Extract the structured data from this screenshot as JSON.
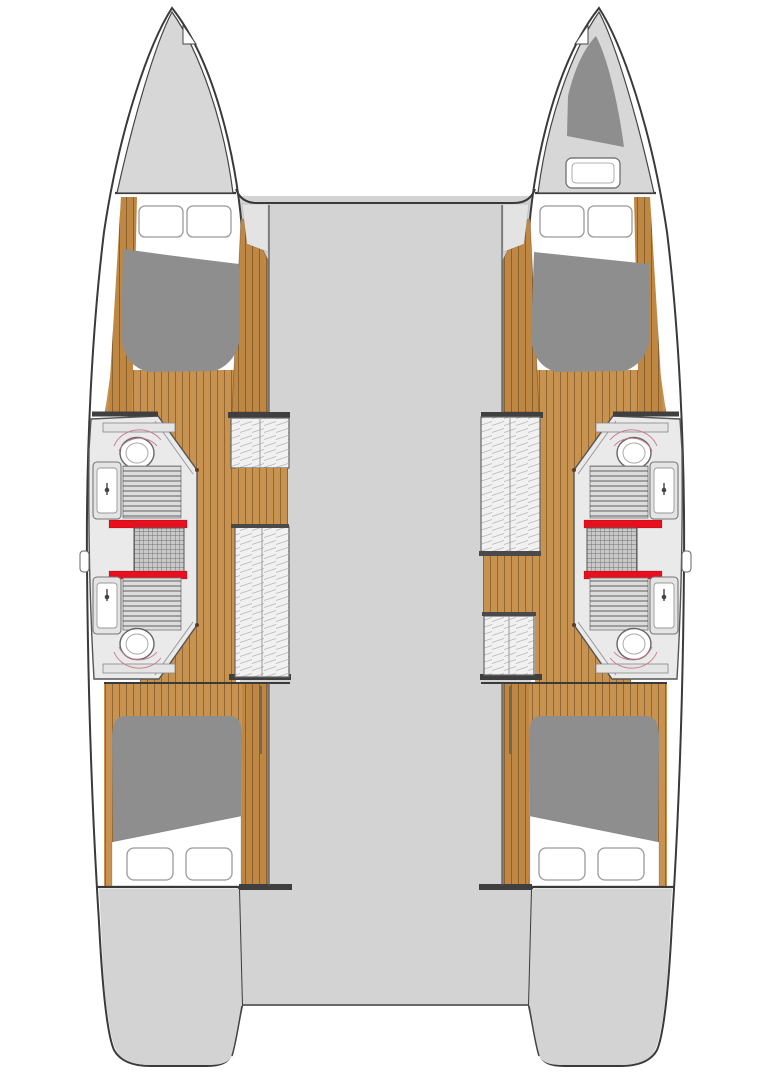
{
  "page": {
    "title": "Catamaran floor plan",
    "description": "Top-view interior layout floor plan of a four-cabin sailing catamaran: two symmetric hulls, each with a forward double cabin, two bathrooms with toilet and sink separated by a central shower grating with red thresholds, wardrobes along the inner wall, an aft double cabin, connected by a central bridge deck with bow trampoline gap and stern cockpit notch.",
    "width_px": 771,
    "height_px": 1080
  },
  "colors": {
    "background": "#FFFFFF",
    "outline": "#3A3A3A",
    "deck": "#D3D3D4",
    "foredeck": "#D7D7D7",
    "side_strip": "#E3E3E3",
    "wood": "#C89350",
    "wood_dark": "#BE8743",
    "mattress": "#8E8E8F",
    "locker_dark": "#8E8E8F",
    "cabinet": "#EAEAEA",
    "fixture_fill": "#E4E4E4",
    "slat_fill": "#DCDCDC",
    "grate_fill": "#C9C9C9",
    "wardrobe": "#F1F1F1",
    "accent_red": "#E8101E",
    "swing_arc_pink": "#C4798A",
    "white": "#FFFFFF"
  },
  "plan": {
    "bridge_deck": {
      "name": "bridge-deck",
      "features": [
        "foredeck-gap-between-bows",
        "stern-cockpit-notch",
        "transom-platforms"
      ]
    },
    "hulls": [
      {
        "id": "port-hull",
        "side": "left",
        "rooms": [
          "bow-locker",
          "forward-cabin",
          "forward-head",
          "shower",
          "aft-head",
          "aft-cabin",
          "transom-platform"
        ],
        "visible_fixtures": {
          "double_beds": 2,
          "pillows": 4,
          "toilets": 2,
          "sinks": 2,
          "shower_gratings": 1,
          "red_thresholds": 2,
          "wardrobes": 2,
          "portholes": 1
        },
        "wardrobe_arrangement": "small-forward, large-aft"
      },
      {
        "id": "starboard-hull",
        "side": "right",
        "rooms": [
          "bow-locker-with-hatch",
          "forward-cabin",
          "forward-head",
          "shower",
          "aft-head",
          "aft-cabin",
          "transom-platform"
        ],
        "visible_fixtures": {
          "double_beds": 2,
          "pillows": 4,
          "toilets": 2,
          "sinks": 2,
          "shower_gratings": 1,
          "red_thresholds": 2,
          "wardrobes": 2,
          "portholes": 1,
          "bow_hatch": 1
        },
        "wardrobe_arrangement": "large-forward, small-aft"
      }
    ]
  }
}
